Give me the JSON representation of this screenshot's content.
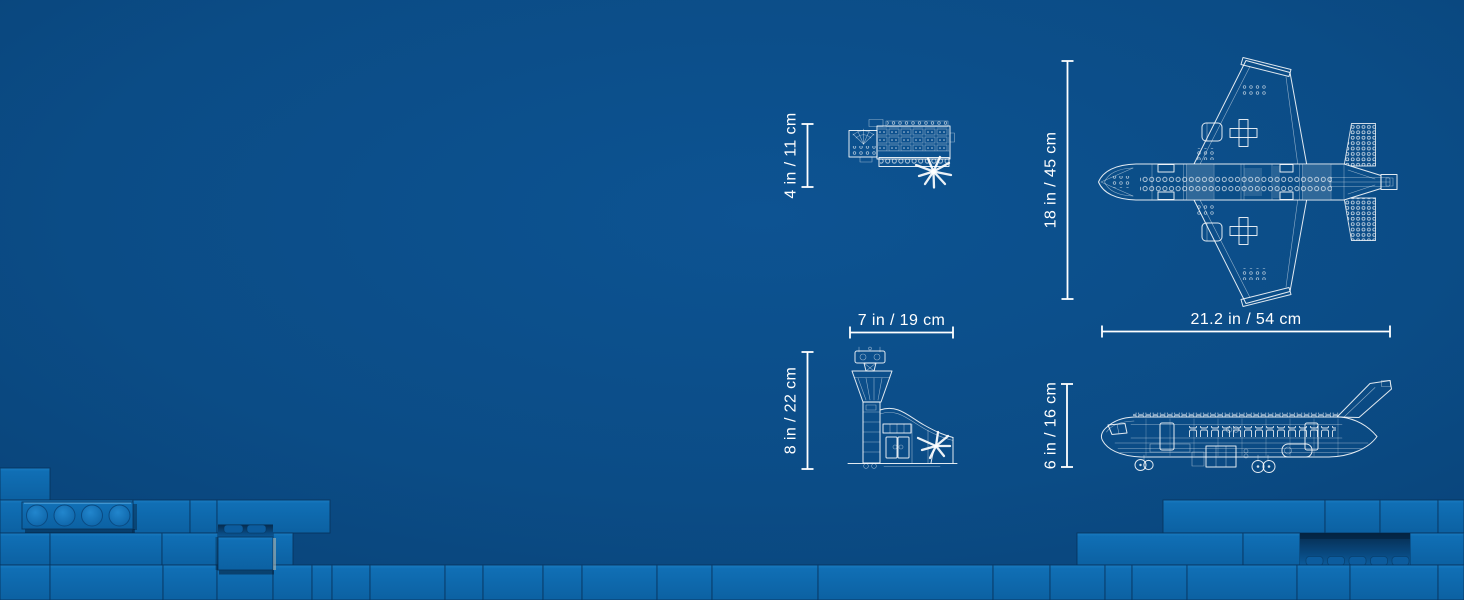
{
  "measurements": {
    "terminal_depth": "4 in / 11 cm",
    "plane_wingspan": "18 in / 45 cm",
    "plane_length": "21.2 in / 54 cm",
    "tower_width": "7 in / 19 cm",
    "tower_height": "8 in / 22 cm",
    "plane_height": "6 in / 16 cm"
  },
  "drawings": [
    "airport-terminal-top-view-blueprint",
    "passenger-airplane-top-view-blueprint",
    "control-tower-terminal-side-view-blueprint",
    "passenger-airplane-side-view-blueprint",
    "lego-brick-wall"
  ],
  "colors": {
    "background": "#0b4d87",
    "brick_face": "#0f6db3",
    "brick_seam": "#07335c",
    "blueprint_line": "#ffffff",
    "dimension_text": "#ffffff"
  }
}
